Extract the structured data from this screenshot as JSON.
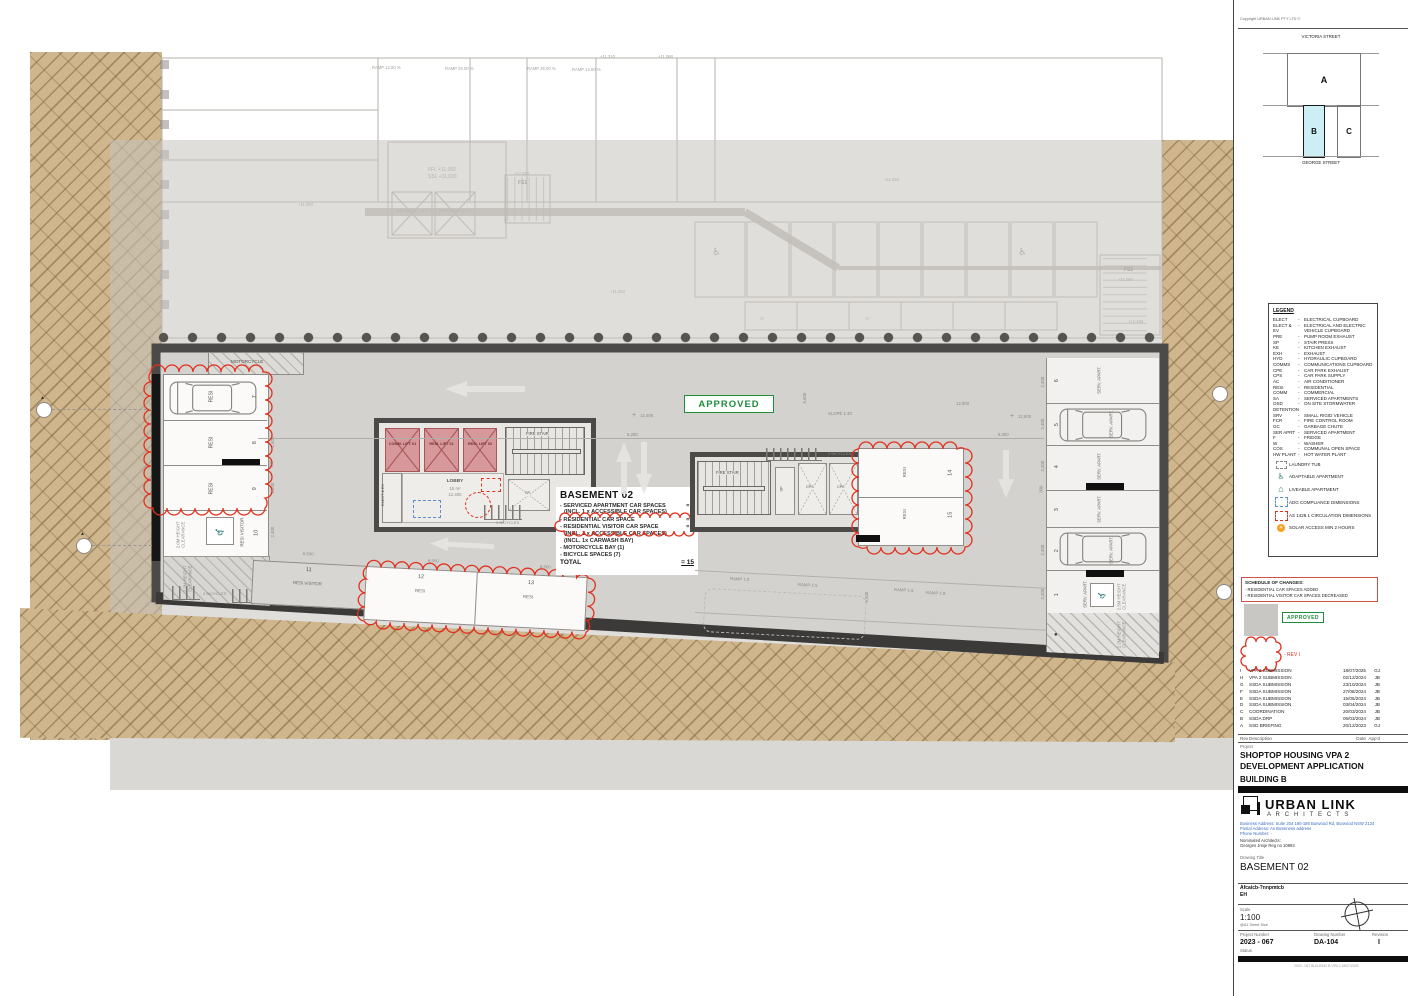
{
  "icons": {
    "wheelchair": "♿",
    "house": "⌂",
    "sun": "☀",
    "tri": "▲",
    "cross": "+",
    "dot": "●"
  },
  "upper": {
    "ramp_1250": "RAMP 12.50 %",
    "ramp_2500": "RAMP 25.00 %",
    "lvl_11310": "+11,310",
    "lvl_11060": "+11,060",
    "lvl_12490": "+12,490",
    "ffl": "FFL +11,060",
    "ssl": "SSL +11,020",
    "fs1": "FS1",
    "fs2": "FS2",
    "el1": "EMERGENCY LIFT 1",
    "el2": "EMERGENCY LIFT 2",
    "st": "ST"
  },
  "plan": {
    "labels": {
      "motorcycle": "MOTORCYCLE",
      "resi": "RESI",
      "resi_visitor": "RESI VISITOR",
      "serv_apart": "SERV. APART.",
      "fire_stair": "FIRE STAIR",
      "lobby": "LOBBY",
      "lobby_area": "15 m²",
      "lobby_level": "12,400",
      "lift_comm": "COMM. LIFT 01",
      "lift_resi1": "RESI. LIFT 01",
      "lift_resi2": "RESI. LIFT 02",
      "elect_ev": "ELECT & EV",
      "sp": "SP",
      "cps": "CPS",
      "cpe": "CPE",
      "bikes2": "2 BICYCLES",
      "bikes3": "3 BICYCLES",
      "clear20": "2.0M HEIGHT CLEARANCE",
      "clear22": "2.2M HEIGHT CLEARANCE",
      "clear25": "2.5M HEIGHT CLEARANCE",
      "slope": "SLOPE 1:40",
      "approved": "APPROVED"
    },
    "bays": [
      "7",
      "8",
      "9",
      "10",
      "11",
      "12",
      "13",
      "14",
      "15"
    ],
    "serv_bays": [
      "6",
      "5",
      "4",
      "3",
      "2",
      "1"
    ],
    "dims": {
      "d12400": "12,400",
      "d12800": "12,800",
      "d6250": "6,250",
      "d6050": "6,050",
      "d6500": "6,500",
      "d2400": "2,400",
      "d300": "300",
      "d5500": "5,500",
      "d5600": "5,600"
    },
    "ramps": {
      "r18": "RAMP 1:8",
      "r15": "RAMP 1:5"
    },
    "summary": {
      "title": "BASEMENT 02",
      "s1": "- SERVICED APARTMENT CAR SPACES",
      "s1v": "= 6",
      "s1b": "(INCL. 1 x ACCESSIBLE CAR SPACES)",
      "s2": "- RESIDENTIAL CAR SPACE",
      "s2v": "= 7",
      "s3": "- RESIDENTIAL VISITOR CAR SPACE",
      "s3v": "= 2",
      "s3b": "(INCL. 1 x ACCESSIBLE CAR SPACES)",
      "s3c": "(INCL. 1x CARWASH BAY)",
      "s4": "- MOTORCYCLE BAY (1)",
      "s5": "- BICYCLE SPACES (7)",
      "total": "TOTAL",
      "totalv": "= 15"
    }
  },
  "titleblock": {
    "copyright": "Copyright URBAN LINK PTY LTD ©",
    "keymap": {
      "street_top": "VICTORIA STREET",
      "street_bottom": "GEORGE STREET",
      "block_a": "A",
      "block_b": "B",
      "block_c": "C"
    },
    "legend": {
      "title": "LEGEND",
      "entries": [
        {
          "a": "ELECT",
          "d": "ELECTRICAL CUPBOARD"
        },
        {
          "a": "ELECT & EV",
          "d": "ELECTRICAL AND ELECTRIC VEHICLE CUPBOARD"
        },
        {
          "a": "PRE",
          "d": "PUMP ROOM EXHAUST"
        },
        {
          "a": "SP",
          "d": "STAIR PRESS"
        },
        {
          "a": "KE",
          "d": "KITCHEN EXHAUST"
        },
        {
          "a": "EXH",
          "d": "EXHAUST"
        },
        {
          "a": "HYD",
          "d": "HYDRAULIC CUPBOARD"
        },
        {
          "a": "COMMS",
          "d": "COMMUNICATIONS CUPBOARD"
        },
        {
          "a": "CPE",
          "d": "CAR PARK EXHAUST"
        },
        {
          "a": "CPS",
          "d": "CAR PARK SUPPLY"
        },
        {
          "a": "AC",
          "d": "AIR CONDITIONER"
        },
        {
          "a": "RESI",
          "d": "RESIDENTIAL"
        },
        {
          "a": "COMM",
          "d": "COMMERCIAL"
        },
        {
          "a": "SA",
          "d": "SERVICED APARTMENTS"
        },
        {
          "a": "OSD DETENTION",
          "d": "ON SITE STORMWATER"
        },
        {
          "a": "SRV",
          "d": "SMALL RIGID VEHICLE"
        },
        {
          "a": "FCR",
          "d": "FIRE CONTROL ROOM"
        },
        {
          "a": "GC",
          "d": "GARBAGE CHUTE"
        },
        {
          "a": "SER APRT",
          "d": "SERVICED APARTMENT"
        },
        {
          "a": "F",
          "d": "FRIDGE"
        },
        {
          "a": "W",
          "d": "WASHER"
        },
        {
          "a": "COS",
          "d": "COMMUNAL OPEN SPACE"
        },
        {
          "a": "HW PLANT",
          "d": "HOT WATER PLANT"
        }
      ],
      "icons": [
        {
          "d": "LAUNDRY TUB"
        },
        {
          "d": "ADAPTABLE APARTMENT"
        },
        {
          "d": "LIVEABLE APARTMENT"
        },
        {
          "d": "ADG COMPLIANCE DIMENSIONS"
        },
        {
          "d": "AS 1428.1 CIRCULATION DIMENSIONS"
        },
        {
          "d": "SOLAR ACCESS MIN 2 HOURS"
        }
      ]
    },
    "schedule": {
      "title": "SCHEDULE OF CHANGES:",
      "i1": "- RESIDENTIAL CAR SPACES ADDED",
      "i2": "- RESIDENTIAL VISITOR CAR SPACES DECREASED"
    },
    "approved_stamp": "APPROVED",
    "rev_cloud_label": "-  REV I",
    "revisions": [
      {
        "rev": "I",
        "desc": "VPA 2 SUBMISSION",
        "date": "18/07/2025",
        "appd": "GJ"
      },
      {
        "rev": "H",
        "desc": "VPA 2 SUBMISSION",
        "date": "02/12/2024",
        "appd": "JB"
      },
      {
        "rev": "G",
        "desc": "SSDA SUBMISSION",
        "date": "23/10/2024",
        "appd": "JB"
      },
      {
        "rev": "F",
        "desc": "SSDA SUBMISSION",
        "date": "27/08/2024",
        "appd": "JB"
      },
      {
        "rev": "E",
        "desc": "SSDA SUBMISSION",
        "date": "15/05/2024",
        "appd": "JB"
      },
      {
        "rev": "D",
        "desc": "SSDA SUBMISSION",
        "date": "03/04/2024",
        "appd": "JB"
      },
      {
        "rev": "C",
        "desc": "COORDINATION",
        "date": "20/03/2024",
        "appd": "JB"
      },
      {
        "rev": "B",
        "desc": "SSDA DRP",
        "date": "06/03/2024",
        "appd": "JB"
      },
      {
        "rev": "A",
        "desc": "SSD BRIEFING",
        "date": "20/12/2023",
        "appd": "GJ"
      }
    ],
    "rev_footer": {
      "rev": "Rev",
      "desc": "Description",
      "date": "Date",
      "appd": "App'd"
    },
    "project_label": "Project",
    "project_name_1": "SHOPTOP HOUSING VPA 2",
    "project_name_2": "DEVELOPMENT APPLICATION",
    "building": "BUILDING B",
    "firm": "URBAN LINK",
    "firm_sub": "A R C H I T E C T S",
    "addr1": "Business Address: Suite 204 180-186 Burwood Rd,  Burwood NSW 2134",
    "addr2": "Postal Address: As Bussiness address",
    "addr3": "Phone Number: -",
    "nominated": "Nominated Architects:",
    "architect": "Georges Jreije Reg no 10993",
    "drawing_title_label": "Drawing Title",
    "drawing_title": "BASEMENT 02",
    "mystery1": "Afcaicb-?nnpmtcb",
    "mystery2": "EH",
    "scale_label": "Scale",
    "scale": "1:100",
    "sheet": "@A1 Sheet Size",
    "project_number_label": "Project Number",
    "project_number": "2023 - 067",
    "drawing_number_label": "Drawing Number",
    "drawing_number": "DA-104",
    "revision_label": "Revision",
    "revision": "I",
    "status_label": "Status",
    "fineprint": "2023 - 067  BUILDING B  VPA 2  18/07/2025"
  }
}
